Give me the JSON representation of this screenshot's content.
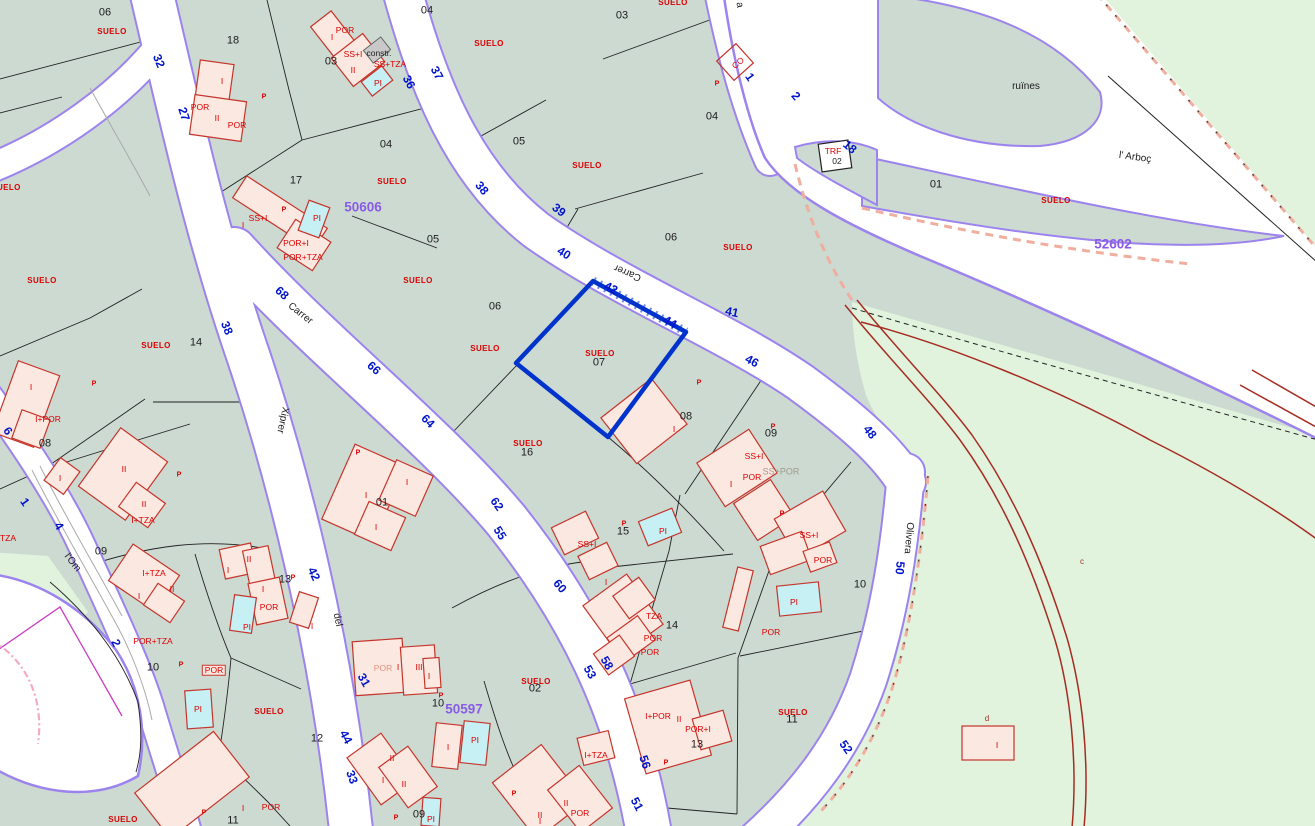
{
  "map": {
    "kind": "cadastral-parcel-map",
    "selected_parcel": {
      "number": "07",
      "land_use": "SUELO"
    },
    "zone_numbers": [
      "50606",
      "52602",
      "50597"
    ],
    "street_names": [
      "Carrer",
      "Xiprer",
      "del",
      "l'Om",
      "Olivera",
      "l' Arboç"
    ],
    "place_names": [
      "ruïnes"
    ],
    "land_use_label": "SUELO"
  },
  "colors": {
    "teal": "#ccdad2",
    "green": "#e1f3dd",
    "purple": "#9c83ee",
    "blue": "#0014cc",
    "selblue": "#0033cc",
    "purplenum": "#8a5ce6",
    "redtext": "#dd0000",
    "redbld": "#c5352b",
    "bldfill": "#fbe8e1",
    "poolfill": "#c6f0f4",
    "track": "#a62c22",
    "salmon": "#efae9e",
    "magenta": "#cc3ec4",
    "pinkdash": "#f2aac6"
  },
  "labels": [
    {
      "t": "06",
      "x": 105,
      "y": 13,
      "c": "n"
    },
    {
      "t": "18",
      "x": 233,
      "y": 41,
      "c": "n"
    },
    {
      "t": "03",
      "x": 331,
      "y": 62,
      "c": "n"
    },
    {
      "t": "04",
      "x": 427,
      "y": 11,
      "c": "n"
    },
    {
      "t": "04",
      "x": 386,
      "y": 145,
      "c": "n"
    },
    {
      "t": "17",
      "x": 296,
      "y": 181,
      "c": "n"
    },
    {
      "t": "05",
      "x": 433,
      "y": 240,
      "c": "n"
    },
    {
      "t": "05",
      "x": 519,
      "y": 142,
      "c": "n"
    },
    {
      "t": "03",
      "x": 622,
      "y": 16,
      "c": "n"
    },
    {
      "t": "04",
      "x": 712,
      "y": 117,
      "c": "n"
    },
    {
      "t": "06",
      "x": 671,
      "y": 238,
      "c": "n"
    },
    {
      "t": "01",
      "x": 936,
      "y": 185,
      "c": "n"
    },
    {
      "t": "06",
      "x": 495,
      "y": 307,
      "c": "n"
    },
    {
      "t": "07",
      "x": 599,
      "y": 363,
      "c": "n"
    },
    {
      "t": "14",
      "x": 196,
      "y": 343,
      "c": "n"
    },
    {
      "t": "08",
      "x": 686,
      "y": 417,
      "c": "n"
    },
    {
      "t": "09",
      "x": 771,
      "y": 434,
      "c": "n"
    },
    {
      "t": "08",
      "x": 45,
      "y": 444,
      "c": "n"
    },
    {
      "t": "01",
      "x": 382,
      "y": 503,
      "c": "n"
    },
    {
      "t": "16",
      "x": 527,
      "y": 453,
      "c": "n"
    },
    {
      "t": "15",
      "x": 623,
      "y": 532,
      "c": "n"
    },
    {
      "t": "10",
      "x": 860,
      "y": 585,
      "c": "n"
    },
    {
      "t": "09",
      "x": 101,
      "y": 552,
      "c": "n"
    },
    {
      "t": "13",
      "x": 285,
      "y": 580,
      "c": "n"
    },
    {
      "t": "10",
      "x": 153,
      "y": 668,
      "c": "n"
    },
    {
      "t": "12",
      "x": 317,
      "y": 739,
      "c": "n"
    },
    {
      "t": "14",
      "x": 672,
      "y": 626,
      "c": "n"
    },
    {
      "t": "02",
      "x": 535,
      "y": 689,
      "c": "n"
    },
    {
      "t": "10",
      "x": 438,
      "y": 704,
      "c": "n"
    },
    {
      "t": "13",
      "x": 697,
      "y": 745,
      "c": "n"
    },
    {
      "t": "11",
      "x": 792,
      "y": 720,
      "c": "n"
    },
    {
      "t": "11",
      "x": 233,
      "y": 821,
      "c": "n"
    },
    {
      "t": "09",
      "x": 419,
      "y": 815,
      "c": "n"
    },
    {
      "t": "02",
      "x": 837,
      "y": 161,
      "c": "ns"
    },
    {
      "t": "constr.",
      "x": 379,
      "y": 53,
      "c": "ns"
    },
    {
      "t": "ruïnes",
      "x": 1026,
      "y": 87,
      "c": "nm"
    },
    {
      "t": "l' Arboç",
      "x": 1135,
      "y": 158,
      "c": "nm",
      "r": 8
    },
    {
      "t": "Carrer",
      "x": 300,
      "y": 314,
      "c": "nm",
      "r": 38
    },
    {
      "t": "Carrer",
      "x": 628,
      "y": 272,
      "c": "nm",
      "r": 203
    },
    {
      "t": "Xiprer",
      "x": 282,
      "y": 420,
      "c": "nm",
      "r": 102
    },
    {
      "t": "del",
      "x": 337,
      "y": 620,
      "c": "nm",
      "r": 78
    },
    {
      "t": "l'Om",
      "x": 72,
      "y": 563,
      "c": "nm",
      "r": 52
    },
    {
      "t": "Olivera",
      "x": 908,
      "y": 538,
      "c": "nm",
      "r": 95
    },
    {
      "t": "a",
      "x": 739,
      "y": 5,
      "c": "nm",
      "r": 80
    },
    {
      "t": "32",
      "x": 159,
      "y": 61,
      "c": "st",
      "r": 68
    },
    {
      "t": "27",
      "x": 184,
      "y": 114,
      "c": "st",
      "r": 72
    },
    {
      "t": "36",
      "x": 409,
      "y": 82,
      "c": "st",
      "r": 62
    },
    {
      "t": "37",
      "x": 437,
      "y": 73,
      "c": "st",
      "r": 62
    },
    {
      "t": "38",
      "x": 482,
      "y": 188,
      "c": "st",
      "r": 50
    },
    {
      "t": "39",
      "x": 559,
      "y": 210,
      "c": "st",
      "r": 38
    },
    {
      "t": "40",
      "x": 564,
      "y": 253,
      "c": "st",
      "r": 32
    },
    {
      "t": "42",
      "x": 611,
      "y": 288,
      "c": "st",
      "r": 28
    },
    {
      "t": "44",
      "x": 670,
      "y": 322,
      "c": "st",
      "r": 30
    },
    {
      "t": "41",
      "x": 732,
      "y": 312,
      "c": "st",
      "r": 12
    },
    {
      "t": "46",
      "x": 752,
      "y": 361,
      "c": "st",
      "r": 28
    },
    {
      "t": "48",
      "x": 870,
      "y": 432,
      "c": "st",
      "r": 52
    },
    {
      "t": "1",
      "x": 750,
      "y": 77,
      "c": "st",
      "r": 55
    },
    {
      "t": "2",
      "x": 796,
      "y": 96,
      "c": "st",
      "r": 50
    },
    {
      "t": "18",
      "x": 850,
      "y": 147,
      "c": "st",
      "r": 40
    },
    {
      "t": "68",
      "x": 282,
      "y": 293,
      "c": "st",
      "r": 42
    },
    {
      "t": "66",
      "x": 374,
      "y": 368,
      "c": "st",
      "r": 42
    },
    {
      "t": "64",
      "x": 428,
      "y": 421,
      "c": "st",
      "r": 45
    },
    {
      "t": "38",
      "x": 227,
      "y": 328,
      "c": "st",
      "r": 68
    },
    {
      "t": "62",
      "x": 497,
      "y": 504,
      "c": "st",
      "r": 55
    },
    {
      "t": "55",
      "x": 500,
      "y": 533,
      "c": "st",
      "r": 58
    },
    {
      "t": "60",
      "x": 560,
      "y": 586,
      "c": "st",
      "r": 50
    },
    {
      "t": "58",
      "x": 607,
      "y": 663,
      "c": "st",
      "r": 60
    },
    {
      "t": "53",
      "x": 590,
      "y": 672,
      "c": "st",
      "r": 60
    },
    {
      "t": "56",
      "x": 645,
      "y": 762,
      "c": "st",
      "r": 72
    },
    {
      "t": "51",
      "x": 637,
      "y": 804,
      "c": "st",
      "r": 62
    },
    {
      "t": "6",
      "x": 8,
      "y": 431,
      "c": "st",
      "r": 55
    },
    {
      "t": "1",
      "x": 25,
      "y": 502,
      "c": "st",
      "r": 55
    },
    {
      "t": "4",
      "x": 59,
      "y": 526,
      "c": "st",
      "r": 58
    },
    {
      "t": "2",
      "x": 116,
      "y": 643,
      "c": "st",
      "r": 65
    },
    {
      "t": "42",
      "x": 314,
      "y": 574,
      "c": "st",
      "r": 65
    },
    {
      "t": "31",
      "x": 364,
      "y": 680,
      "c": "st",
      "r": 60
    },
    {
      "t": "44",
      "x": 346,
      "y": 737,
      "c": "st",
      "r": 62
    },
    {
      "t": "33",
      "x": 352,
      "y": 777,
      "c": "st",
      "r": 70
    },
    {
      "t": "50",
      "x": 900,
      "y": 568,
      "c": "st",
      "r": 95
    },
    {
      "t": "52",
      "x": 846,
      "y": 747,
      "c": "st",
      "r": 55
    },
    {
      "t": "50606",
      "x": 363,
      "y": 207,
      "c": "z"
    },
    {
      "t": "52602",
      "x": 1113,
      "y": 244,
      "c": "z"
    },
    {
      "t": "50597",
      "x": 464,
      "y": 709,
      "c": "z"
    },
    {
      "t": "SUELO",
      "x": 112,
      "y": 32,
      "c": "su"
    },
    {
      "t": "SUELO",
      "x": 6,
      "y": 188,
      "c": "su"
    },
    {
      "t": "SUELO",
      "x": 392,
      "y": 182,
      "c": "su"
    },
    {
      "t": "SUELO",
      "x": 489,
      "y": 44,
      "c": "su"
    },
    {
      "t": "SUELO",
      "x": 587,
      "y": 166,
      "c": "su"
    },
    {
      "t": "SUELO",
      "x": 673,
      "y": 3,
      "c": "su"
    },
    {
      "t": "SUELO",
      "x": 738,
      "y": 248,
      "c": "su"
    },
    {
      "t": "SUELO",
      "x": 1056,
      "y": 201,
      "c": "su"
    },
    {
      "t": "SUELO",
      "x": 42,
      "y": 281,
      "c": "su"
    },
    {
      "t": "SUELO",
      "x": 418,
      "y": 281,
      "c": "su"
    },
    {
      "t": "SUELO",
      "x": 156,
      "y": 346,
      "c": "su"
    },
    {
      "t": "SUELO",
      "x": 485,
      "y": 349,
      "c": "su"
    },
    {
      "t": "SUELO",
      "x": 600,
      "y": 354,
      "c": "su"
    },
    {
      "t": "SUELO",
      "x": 528,
      "y": 444,
      "c": "su"
    },
    {
      "t": "SUELO",
      "x": 269,
      "y": 712,
      "c": "su"
    },
    {
      "t": "SUELO",
      "x": 123,
      "y": 820,
      "c": "su"
    },
    {
      "t": "SUELO",
      "x": 536,
      "y": 682,
      "c": "su"
    },
    {
      "t": "SUELO",
      "x": 793,
      "y": 713,
      "c": "su"
    },
    {
      "t": "POR",
      "x": 200,
      "y": 107,
      "c": "b"
    },
    {
      "t": "POR",
      "x": 237,
      "y": 125,
      "c": "b"
    },
    {
      "t": "I",
      "x": 222,
      "y": 81,
      "c": "b"
    },
    {
      "t": "II",
      "x": 217,
      "y": 118,
      "c": "b"
    },
    {
      "t": "I",
      "x": 332,
      "y": 37,
      "c": "b"
    },
    {
      "t": "POR",
      "x": 345,
      "y": 30,
      "c": "b"
    },
    {
      "t": "SS+I",
      "x": 353,
      "y": 54,
      "c": "b"
    },
    {
      "t": "SS+TZA",
      "x": 390,
      "y": 64,
      "c": "b"
    },
    {
      "t": "PI",
      "x": 378,
      "y": 83,
      "c": "b"
    },
    {
      "t": "II",
      "x": 353,
      "y": 70,
      "c": "b"
    },
    {
      "t": "CO",
      "x": 738,
      "y": 63,
      "c": "b",
      "r": -40
    },
    {
      "t": "TRF",
      "x": 833,
      "y": 151,
      "c": "b"
    },
    {
      "t": "SS+I",
      "x": 258,
      "y": 218,
      "c": "b"
    },
    {
      "t": "I",
      "x": 243,
      "y": 225,
      "c": "b"
    },
    {
      "t": "POR+I",
      "x": 296,
      "y": 243,
      "c": "b"
    },
    {
      "t": "POR+TZA",
      "x": 303,
      "y": 257,
      "c": "b"
    },
    {
      "t": "PI",
      "x": 317,
      "y": 218,
      "c": "b"
    },
    {
      "t": "I+POR",
      "x": 48,
      "y": 419,
      "c": "b"
    },
    {
      "t": "I",
      "x": 31,
      "y": 387,
      "c": "b"
    },
    {
      "t": "I",
      "x": 60,
      "y": 478,
      "c": "b"
    },
    {
      "t": "II",
      "x": 124,
      "y": 469,
      "c": "b"
    },
    {
      "t": "II",
      "x": 144,
      "y": 504,
      "c": "b"
    },
    {
      "t": "I+TZA",
      "x": 143,
      "y": 520,
      "c": "b"
    },
    {
      "t": "I",
      "x": 366,
      "y": 495,
      "c": "b"
    },
    {
      "t": "I",
      "x": 407,
      "y": 482,
      "c": "b"
    },
    {
      "t": "I",
      "x": 376,
      "y": 527,
      "c": "b"
    },
    {
      "t": "I",
      "x": 674,
      "y": 429,
      "c": "b"
    },
    {
      "t": "SS+I",
      "x": 754,
      "y": 456,
      "c": "b"
    },
    {
      "t": "POR",
      "x": 752,
      "y": 477,
      "c": "b"
    },
    {
      "t": "SS+POR",
      "x": 781,
      "y": 472,
      "c": "bg"
    },
    {
      "t": "I",
      "x": 731,
      "y": 484,
      "c": "b"
    },
    {
      "t": "SS+I",
      "x": 809,
      "y": 535,
      "c": "b"
    },
    {
      "t": "PI",
      "x": 663,
      "y": 531,
      "c": "b"
    },
    {
      "t": "SS+I",
      "x": 587,
      "y": 544,
      "c": "b"
    },
    {
      "t": "TZA",
      "x": 8,
      "y": 538,
      "c": "b"
    },
    {
      "t": "I+TZA",
      "x": 154,
      "y": 573,
      "c": "b"
    },
    {
      "t": "II",
      "x": 172,
      "y": 589,
      "c": "b"
    },
    {
      "t": "I",
      "x": 139,
      "y": 596,
      "c": "b"
    },
    {
      "t": "POR+TZA",
      "x": 153,
      "y": 641,
      "c": "b"
    },
    {
      "t": "I",
      "x": 228,
      "y": 570,
      "c": "b"
    },
    {
      "t": "II",
      "x": 249,
      "y": 559,
      "c": "b"
    },
    {
      "t": "I",
      "x": 263,
      "y": 589,
      "c": "b"
    },
    {
      "t": "POR",
      "x": 269,
      "y": 607,
      "c": "b"
    },
    {
      "t": "PI",
      "x": 247,
      "y": 627,
      "c": "b"
    },
    {
      "t": "I",
      "x": 312,
      "y": 626,
      "c": "b"
    },
    {
      "t": "POR",
      "x": 214,
      "y": 670,
      "c": "bp"
    },
    {
      "t": "PI",
      "x": 198,
      "y": 709,
      "c": "b"
    },
    {
      "t": "POR",
      "x": 383,
      "y": 668,
      "c": "bf"
    },
    {
      "t": "I",
      "x": 398,
      "y": 667,
      "c": "b"
    },
    {
      "t": "III",
      "x": 419,
      "y": 667,
      "c": "b"
    },
    {
      "t": "I",
      "x": 429,
      "y": 676,
      "c": "b"
    },
    {
      "t": "PI",
      "x": 475,
      "y": 740,
      "c": "b"
    },
    {
      "t": "I",
      "x": 448,
      "y": 747,
      "c": "b"
    },
    {
      "t": "I",
      "x": 243,
      "y": 808,
      "c": "b"
    },
    {
      "t": "POR",
      "x": 271,
      "y": 807,
      "c": "b"
    },
    {
      "t": "II",
      "x": 392,
      "y": 758,
      "c": "b"
    },
    {
      "t": "I",
      "x": 383,
      "y": 780,
      "c": "b"
    },
    {
      "t": "II",
      "x": 404,
      "y": 784,
      "c": "b"
    },
    {
      "t": "PI",
      "x": 431,
      "y": 819,
      "c": "b"
    },
    {
      "t": "I",
      "x": 606,
      "y": 582,
      "c": "b"
    },
    {
      "t": "TZA",
      "x": 654,
      "y": 616,
      "c": "b"
    },
    {
      "t": "POR",
      "x": 653,
      "y": 638,
      "c": "b"
    },
    {
      "t": "POR",
      "x": 650,
      "y": 652,
      "c": "b"
    },
    {
      "t": "I+TZA",
      "x": 596,
      "y": 755,
      "c": "b"
    },
    {
      "t": "II",
      "x": 566,
      "y": 803,
      "c": "b"
    },
    {
      "t": "II",
      "x": 540,
      "y": 815,
      "c": "b"
    },
    {
      "t": "POR",
      "x": 580,
      "y": 813,
      "c": "b"
    },
    {
      "t": "I",
      "x": 540,
      "y": 821,
      "c": "b"
    },
    {
      "t": "I+POR",
      "x": 658,
      "y": 716,
      "c": "b"
    },
    {
      "t": "II",
      "x": 679,
      "y": 719,
      "c": "b"
    },
    {
      "t": "POR+I",
      "x": 698,
      "y": 729,
      "c": "b"
    },
    {
      "t": "POR",
      "x": 771,
      "y": 632,
      "c": "b"
    },
    {
      "t": "POR",
      "x": 823,
      "y": 560,
      "c": "b"
    },
    {
      "t": "PI",
      "x": 794,
      "y": 602,
      "c": "b"
    },
    {
      "t": "I",
      "x": 997,
      "y": 745,
      "c": "b"
    },
    {
      "t": "c",
      "x": 1082,
      "y": 562,
      "c": "tr"
    },
    {
      "t": "d",
      "x": 987,
      "y": 719,
      "c": "tr"
    },
    {
      "t": "P",
      "x": 264,
      "y": 97,
      "c": "p"
    },
    {
      "t": "P",
      "x": 284,
      "y": 210,
      "c": "p"
    },
    {
      "t": "P",
      "x": 717,
      "y": 84,
      "c": "p"
    },
    {
      "t": "P",
      "x": 699,
      "y": 383,
      "c": "p"
    },
    {
      "t": "P",
      "x": 773,
      "y": 427,
      "c": "p"
    },
    {
      "t": "P",
      "x": 358,
      "y": 453,
      "c": "p"
    },
    {
      "t": "P",
      "x": 179,
      "y": 475,
      "c": "p"
    },
    {
      "t": "P",
      "x": 94,
      "y": 384,
      "c": "p"
    },
    {
      "t": "P",
      "x": 624,
      "y": 524,
      "c": "p"
    },
    {
      "t": "P",
      "x": 666,
      "y": 763,
      "c": "p"
    },
    {
      "t": "P",
      "x": 782,
      "y": 514,
      "c": "p"
    },
    {
      "t": "P",
      "x": 181,
      "y": 665,
      "c": "p"
    },
    {
      "t": "P",
      "x": 204,
      "y": 813,
      "c": "p"
    },
    {
      "t": "P",
      "x": 396,
      "y": 818,
      "c": "p"
    },
    {
      "t": "P",
      "x": 514,
      "y": 794,
      "c": "p"
    },
    {
      "t": "P",
      "x": 441,
      "y": 696,
      "c": "p"
    },
    {
      "t": "P",
      "x": 293,
      "y": 578,
      "c": "p"
    }
  ]
}
